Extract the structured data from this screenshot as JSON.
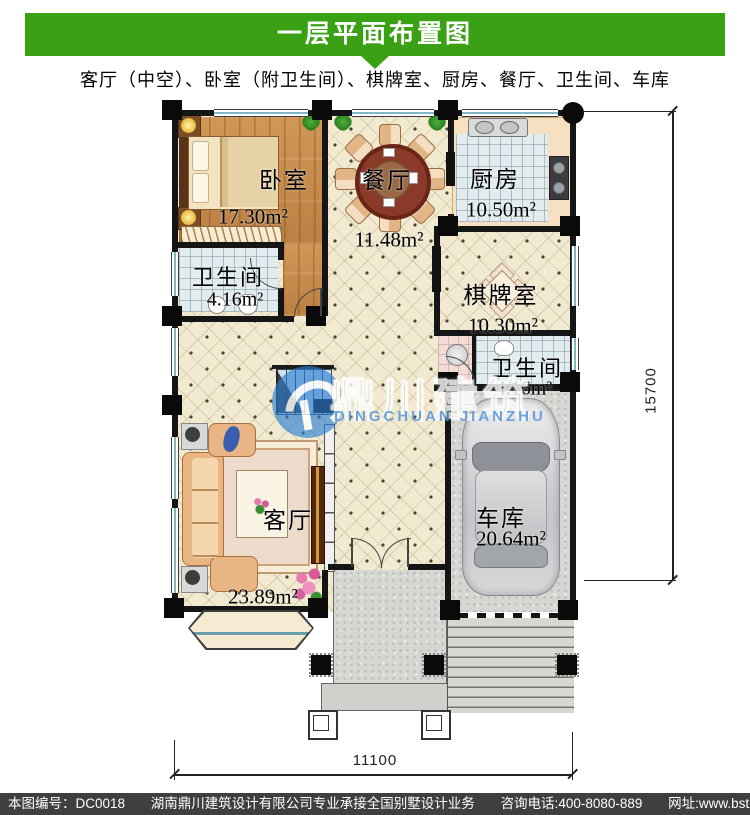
{
  "header": {
    "title": "一层平面布置图",
    "subtitle": "客厅（中空）、卧室（附卫生间）、棋牌室、厨房、餐厅、卫生间、车库"
  },
  "rooms": {
    "bedroom": {
      "name": "卧室",
      "area": "17.30m²"
    },
    "dining": {
      "name": "餐厅",
      "area": "11.48m²"
    },
    "kitchen": {
      "name": "厨房",
      "area": "10.50m²"
    },
    "bath1": {
      "name": "卫生间",
      "area": "4.16m²"
    },
    "chess": {
      "name": "棋牌室",
      "area": "10.30m²"
    },
    "bath2": {
      "name": "卫生间",
      "area": "4.16m²"
    },
    "living": {
      "name": "客厅",
      "area": "23.89m²"
    },
    "garage": {
      "name": "车库",
      "area": "20.64m²"
    }
  },
  "dimensions": {
    "bottom": "11100",
    "right": "15700"
  },
  "watermark": {
    "cn": "鼎川建筑",
    "en": "DINGCHUAN JIANZHU"
  },
  "footer": {
    "code": "本图编号：DC0018",
    "company": "湖南鼎川建筑设计有限公司专业承接全国别墅设计业务",
    "phone": "咨询电话:400-8080-889",
    "website": "网址:www.bstzcs.com"
  },
  "colors": {
    "header_green": "#3aa014",
    "footer_gray": "#3f3f3f",
    "watermark_blue": "#2878cd"
  }
}
